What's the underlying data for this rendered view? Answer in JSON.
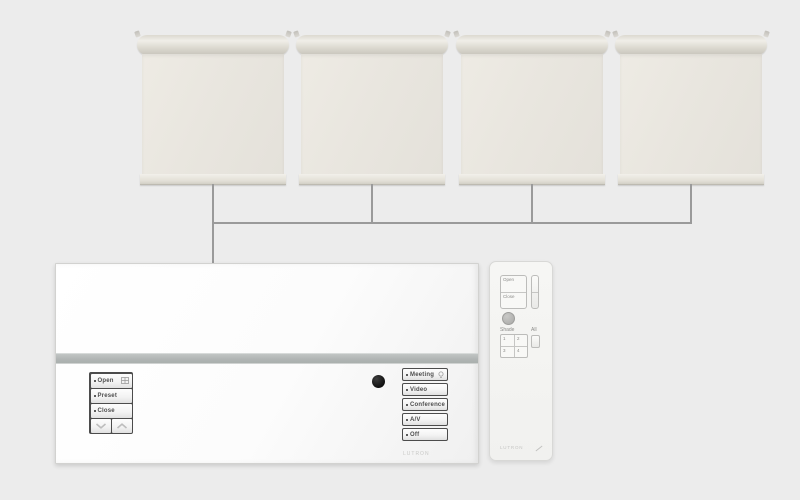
{
  "scene": {
    "background_color": "#ececec",
    "wire_color": "#9a9a9a",
    "shade_count": 4
  },
  "keypad": {
    "brand": "LUTRON",
    "left_group": {
      "buttons": [
        {
          "label": "Open",
          "icon": "window-grid-icon"
        },
        {
          "label": "Preset",
          "icon": ""
        },
        {
          "label": "Close",
          "icon": ""
        }
      ],
      "lower_icon": "chevron-down-icon",
      "raise_icon": "chevron-up-icon"
    },
    "right_group": {
      "buttons": [
        {
          "label": "Meeting",
          "icon": "lightbulb-icon"
        },
        {
          "label": "Video",
          "icon": ""
        },
        {
          "label": "Conference",
          "icon": ""
        },
        {
          "label": "A/V",
          "icon": ""
        },
        {
          "label": "Off",
          "icon": ""
        }
      ]
    }
  },
  "remote": {
    "brand": "LUTRON",
    "open_label": "Open",
    "close_label": "Close",
    "shade_group_label": "Shade",
    "all_group_label": "All",
    "zone_buttons": [
      "1",
      "2",
      "3",
      "4"
    ]
  }
}
